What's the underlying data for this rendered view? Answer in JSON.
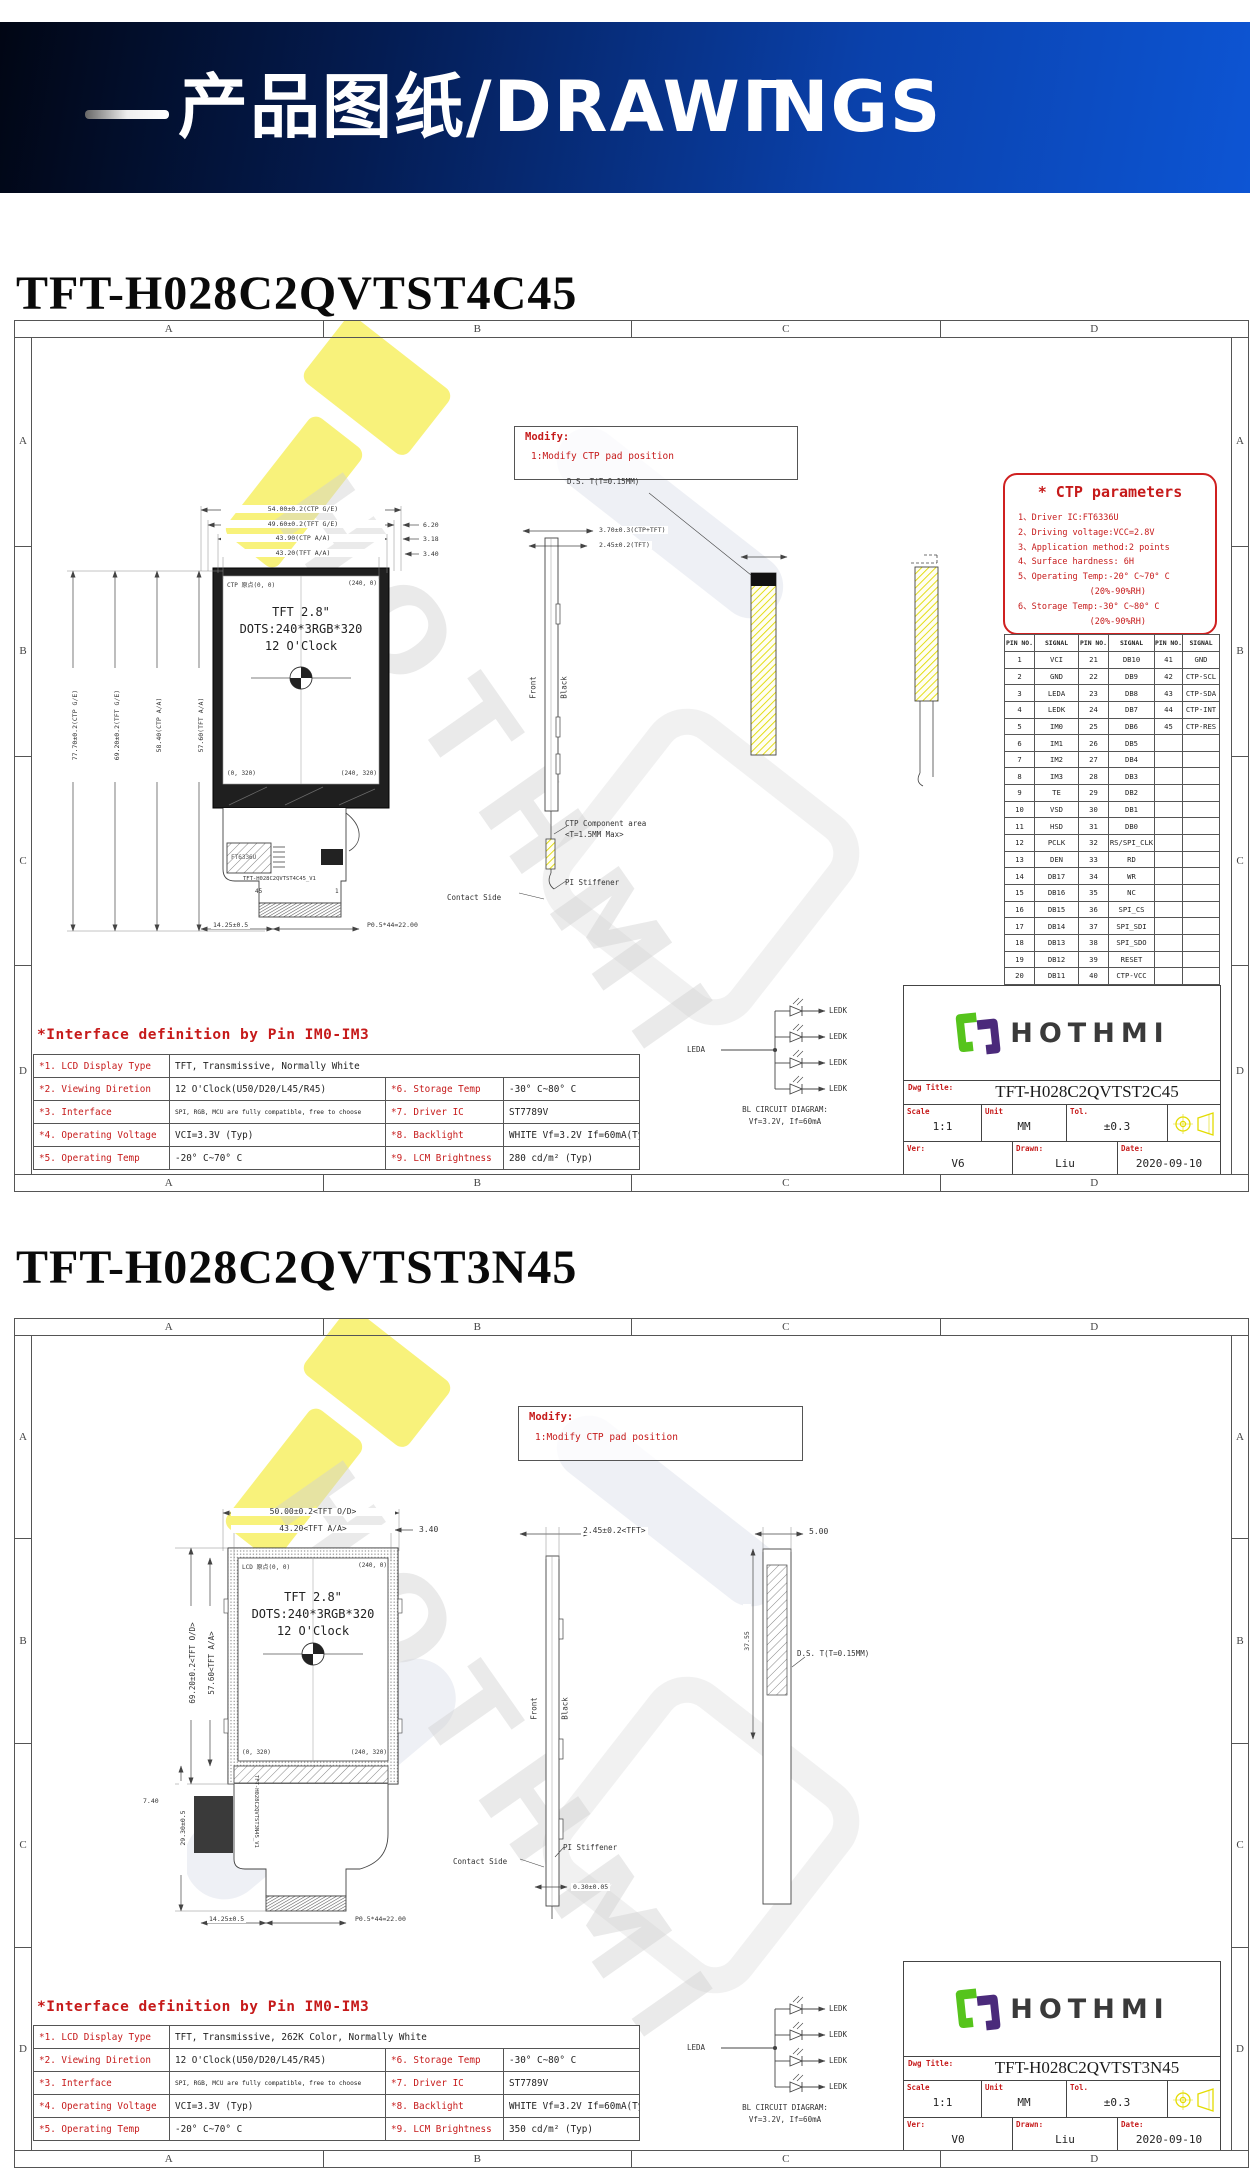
{
  "header": {
    "banner": "产品图纸/DRAWINGS"
  },
  "watermark": "HOTHMI",
  "zones": [
    "A",
    "B",
    "C",
    "D"
  ],
  "s1": {
    "title": "TFT-H028C2QVTST4C45",
    "modify": {
      "t": "Modify:",
      "l": "1:Modify CTP pad position"
    },
    "ctp": {
      "title": "* CTP parameters",
      "lines": [
        "1、Driver IC:FT6336U",
        "2、Driving voltage:VCC=2.8V",
        "3、Application method:2 points",
        "4、Surface hardness: 6H",
        "5、Operating Temp:-20° C~70° C",
        "              (20%-90%RH)",
        "6、Storage Temp:-30° C~80° C",
        "              (20%-90%RH)"
      ]
    },
    "pins": {
      "headers": [
        "PIN NO.",
        "SIGNAL",
        "PIN NO.",
        "SIGNAL",
        "PIN NO.",
        "SIGNAL"
      ],
      "rows": [
        [
          "1",
          "VCI",
          "21",
          "DB10",
          "41",
          "GND"
        ],
        [
          "2",
          "GND",
          "22",
          "DB9",
          "42",
          "CTP-SCL"
        ],
        [
          "3",
          "LEDA",
          "23",
          "DB8",
          "43",
          "CTP-SDA"
        ],
        [
          "4",
          "LEDK",
          "24",
          "DB7",
          "44",
          "CTP-INT"
        ],
        [
          "5",
          "IM0",
          "25",
          "DB6",
          "45",
          "CTP-RES"
        ],
        [
          "6",
          "IM1",
          "26",
          "DB5",
          "",
          ""
        ],
        [
          "7",
          "IM2",
          "27",
          "DB4",
          "",
          ""
        ],
        [
          "8",
          "IM3",
          "28",
          "DB3",
          "",
          ""
        ],
        [
          "9",
          "TE",
          "29",
          "DB2",
          "",
          ""
        ],
        [
          "10",
          "VSD",
          "30",
          "DB1",
          "",
          ""
        ],
        [
          "11",
          "HSD",
          "31",
          "DB0",
          "",
          ""
        ],
        [
          "12",
          "PCLK",
          "32",
          "RS/SPI_CLK",
          "",
          ""
        ],
        [
          "13",
          "DEN",
          "33",
          "RD",
          "",
          ""
        ],
        [
          "14",
          "DB17",
          "34",
          "WR",
          "",
          ""
        ],
        [
          "15",
          "DB16",
          "35",
          "NC",
          "",
          ""
        ],
        [
          "16",
          "DB15",
          "36",
          "SPI_CS",
          "",
          ""
        ],
        [
          "17",
          "DB14",
          "37",
          "SPI_SDI",
          "",
          ""
        ],
        [
          "18",
          "DB13",
          "38",
          "SPI_SDO",
          "",
          ""
        ],
        [
          "19",
          "DB12",
          "39",
          "RESET",
          "",
          ""
        ],
        [
          "20",
          "DB11",
          "40",
          "CTP-VCC",
          "",
          ""
        ]
      ]
    },
    "front": {
      "l1": "TFT 2.8\"",
      "l2": "DOTS:240*3RGB*320",
      "l3": "12 O'Clock",
      "tl": "CTP 原点(0, 0)",
      "tr": "(240, 0)",
      "bl": "(0, 320)",
      "br": "(240, 320)"
    },
    "dims": {
      "top": [
        "54.00±0.2(CTP G/E)",
        "49.60±0.2(TFT G/E)",
        "43.90(CTP A/A)",
        "43.20(TFT A/A)"
      ],
      "right": [
        "6.20",
        "3.18",
        "3.40"
      ],
      "left": [
        "77.70±0.2(CTP G/E)",
        "69.20±0.2(TFT G/E)",
        "58.40(CTP A/A)",
        "57.60(TFT A/A)"
      ],
      "side1": "3.70±0.3(CTP+TFT)",
      "side2": "2.45±0.2(TFT)",
      "ds": "D.S. T(T=0.15MM)",
      "b1": "14.25±0.5",
      "b2": "P0.5*44=22.00"
    },
    "side": {
      "front": "Front",
      "black": "Black",
      "ctp1": "CTP Component area",
      "ctp2": "<T=1.5MM Max>",
      "contact": "Contact Side",
      "pi": "PI Stiffener"
    },
    "fpc": {
      "chip": "FT6336U",
      "label": "TFT-H028C2QVTST4C45_V1",
      "pl": "45",
      "pr": "1"
    },
    "bl": {
      "leda": "LEDA",
      "ledk": "LEDK",
      "c1": "BL CIRCUIT DIAGRAM:",
      "c2": "Vf=3.2V, If=60mA"
    },
    "tb": {
      "logo": "HOTHMI",
      "dwgl": "Dwg Title:",
      "dwg": "TFT-H028C2QVTST2C45",
      "scalel": "Scale",
      "scale": "1:1",
      "unitl": "Unit",
      "unit": "MM",
      "to": "Tol.",
      "tol": "±0.3",
      "verl": "Ver:",
      "ver": "V6",
      "drawnl": "Drawn:",
      "drawn": "Liu",
      "datel": "Date:",
      "date": "2020-09-10"
    },
    "iface": {
      "title": "*Interface definition by Pin IM0-IM3",
      "r1l": "*1. LCD Display Type",
      "r1v": "TFT, Transmissive, Normally White",
      "rows": [
        {
          "l1": "*2. Viewing Diretion",
          "v1": "12 O'Clock(U50/D20/L45/R45)",
          "l2": "*6. Storage Temp",
          "v2": "-30° C~80° C"
        },
        {
          "l1": "*3. Interface",
          "v1": "SPI, RGB, MCU are fully compatible, free to choose",
          "l2": "*7. Driver IC",
          "v2": "ST7789V"
        },
        {
          "l1": "*4. Operating Voltage",
          "v1": "VCI=3.3V (Typ)",
          "l2": "*8. Backlight",
          "v2": "WHITE Vf=3.2V If=60mA(Typ)"
        },
        {
          "l1": "*5. Operating Temp",
          "v1": "-20° C~70° C",
          "l2": "*9. LCM Brightness",
          "v2": "280 cd/m² (Typ)"
        }
      ]
    }
  },
  "s2": {
    "title": "TFT-H028C2QVTST3N45",
    "modify": {
      "t": "Modify:",
      "l": "1:Modify CTP pad position"
    },
    "front": {
      "l1": "TFT 2.8\"",
      "l2": "DOTS:240*3RGB*320",
      "l3": "12 O'Clock",
      "tl": "LCD 原点(0, 0)",
      "tr": "(240, 0)",
      "bl": "(0, 320)",
      "br": "(240, 320)"
    },
    "dims": {
      "top": [
        "50.00±0.2<TFT O/D>",
        "43.20<TFT A/A>"
      ],
      "right": [
        "3.40"
      ],
      "left": [
        "69.20±0.2<TFT O/D>",
        "57.60<TFT A/A>"
      ],
      "side1": "2.45±0.2<TFT>",
      "rv1": "5.00",
      "rv2": "37.55",
      "ds": "D.S. T(T=0.15MM)",
      "b1": "14.25±0.5",
      "b2": "P0.5*44=22.00",
      "b3": "29.30±0.5",
      "b4": "7.40",
      "b5": "0.30±0.05"
    },
    "side": {
      "front": "Front",
      "black": "Black",
      "contact": "Contact Side",
      "pi": "PI Stiffener"
    },
    "fpc": {
      "label": "TFT-H028C2QVTST3N45_V1"
    },
    "bl": {
      "leda": "LEDA",
      "ledk": "LEDK",
      "c1": "BL CIRCUIT DIAGRAM:",
      "c2": "Vf=3.2V, If=60mA"
    },
    "tb": {
      "logo": "HOTHMI",
      "dwgl": "Dwg Title:",
      "dwg": "TFT-H028C2QVTST3N45",
      "scalel": "Scale",
      "scale": "1:1",
      "unitl": "Unit",
      "unit": "MM",
      "to": "Tol.",
      "tol": "±0.3",
      "verl": "Ver:",
      "ver": "V0",
      "drawnl": "Drawn:",
      "drawn": "Liu",
      "datel": "Date:",
      "date": "2020-09-10"
    },
    "iface": {
      "title": "*Interface definition by Pin IM0-IM3",
      "r1l": "*1. LCD Display Type",
      "r1v": "TFT, Transmissive, 262K Color, Normally White",
      "rows": [
        {
          "l1": "*2. Viewing Diretion",
          "v1": "12 O'Clock(U50/D20/L45/R45)",
          "l2": "*6. Storage Temp",
          "v2": "-30° C~80° C"
        },
        {
          "l1": "*3. Interface",
          "v1": "SPI, RGB, MCU are fully compatible, free to choose",
          "l2": "*7. Driver IC",
          "v2": "ST7789V"
        },
        {
          "l1": "*4. Operating Voltage",
          "v1": "VCI=3.3V (Typ)",
          "l2": "*8. Backlight",
          "v2": "WHITE Vf=3.2V If=60mA(Typ)"
        },
        {
          "l1": "*5. Operating Temp",
          "v1": "-20° C~70° C",
          "l2": "*9. LCM Brightness",
          "v2": "350 cd/m² (Typ)"
        }
      ]
    }
  }
}
